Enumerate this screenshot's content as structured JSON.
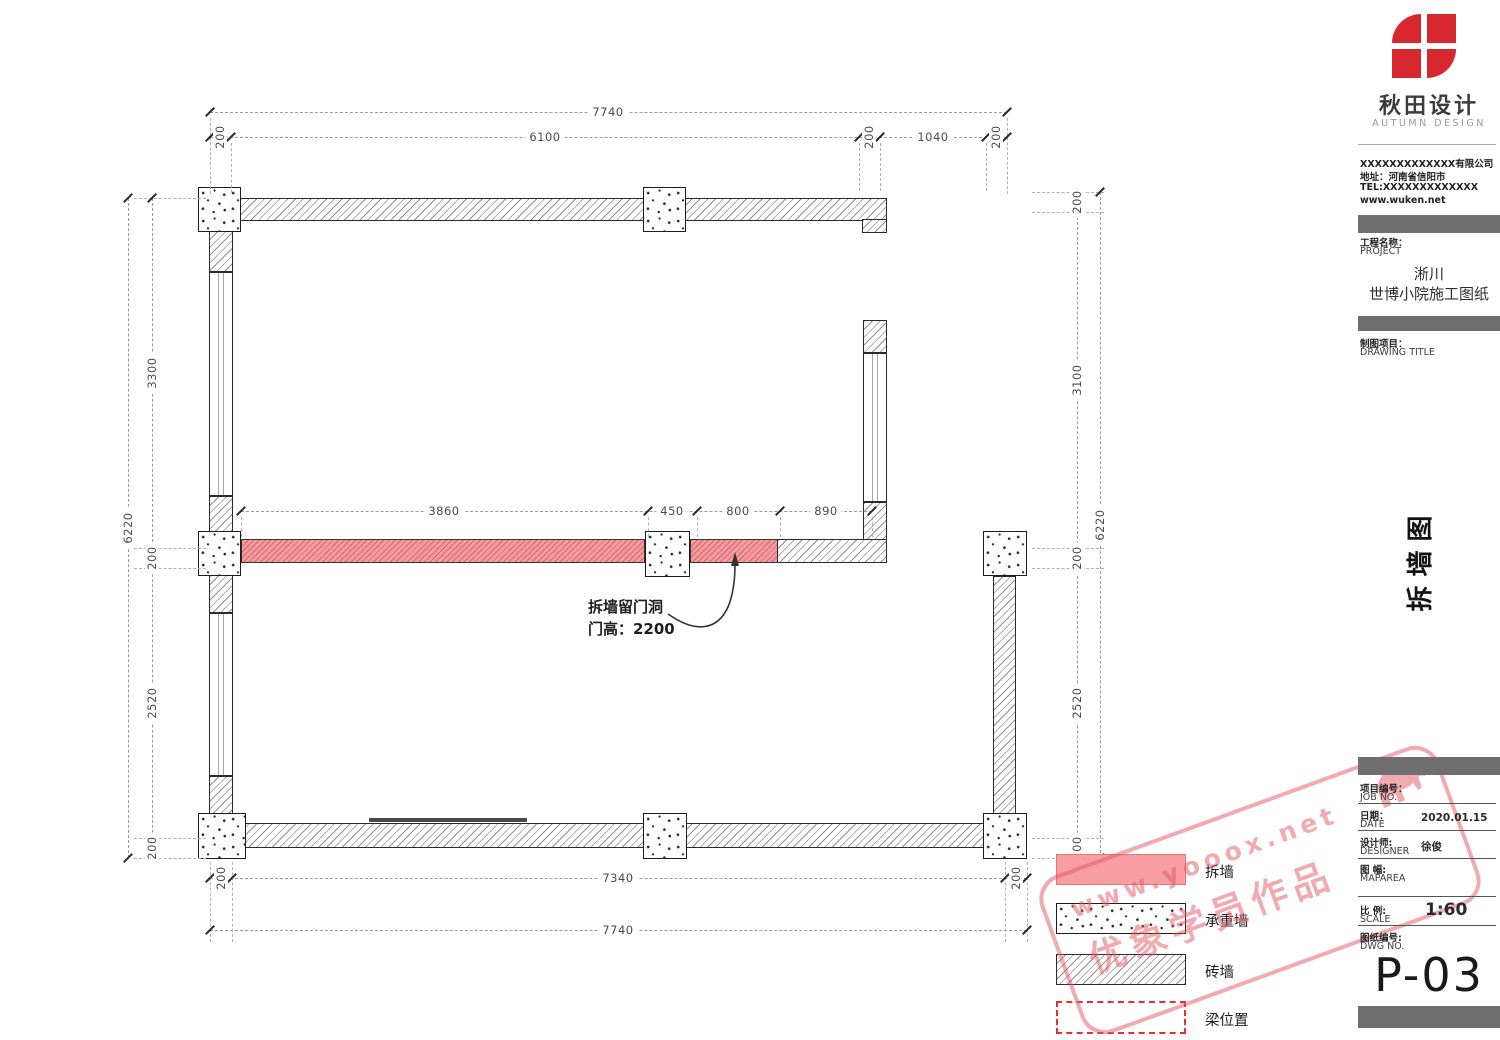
{
  "brand": {
    "logo_cn": "秋田设计",
    "logo_en": "AUTUMN DESIGN",
    "accent_red": "#d7282f"
  },
  "company": {
    "name": "XXXXXXXXXXXXX有限公司",
    "address": "地址：河南省信阳市",
    "tel": "TEL:XXXXXXXXXXXXX",
    "web": "www.wuken.net"
  },
  "project": {
    "label_cn": "工程名称：",
    "label_en": "PROJECT",
    "line1": "淅川",
    "line2": "世博小院施工图纸"
  },
  "drawing_title": {
    "label_cn": "制图项目：",
    "label_en": "DRAWING TITLE",
    "vertical": "拆墙图"
  },
  "fields": {
    "job": {
      "cn": "项目编号：",
      "en": "JOB NO.",
      "value": ""
    },
    "date": {
      "cn": "日期：",
      "en": "DATE",
      "value": "2020.01.15"
    },
    "designer": {
      "cn": "设计师:",
      "en": "DESIGNER",
      "value": "徐俊"
    },
    "maparea": {
      "cn": "图 幅:",
      "en": "MAPAREA",
      "value": ""
    },
    "scale": {
      "cn": "比 例:",
      "en": "SCALE",
      "value": "1:60"
    },
    "dwg": {
      "cn": "图纸编号:",
      "en": "DWG NO.",
      "value": "P-03"
    }
  },
  "plan": {
    "dims": {
      "top_overall": "7740",
      "top_chain": [
        "200",
        "6100",
        "200",
        "1040",
        "200"
      ],
      "left_overall": "6220",
      "left_chain": [
        "3300",
        "200",
        "2520",
        "200"
      ],
      "right_overall": "6220",
      "right_chain": [
        "200",
        "3100",
        "200",
        "2520",
        "200"
      ],
      "mid_chain": [
        "3860",
        "450",
        "800",
        "890"
      ],
      "bottom_chain": [
        "200",
        "7340",
        "200"
      ],
      "bottom_overall": "7740"
    },
    "annotation": {
      "line1": "拆墙留门洞",
      "line2": "门高：2200"
    },
    "colors": {
      "demolition_pink": "#f4999c",
      "wall_line": "#2b2b2b"
    }
  },
  "legend": {
    "items": [
      {
        "id": "demolish",
        "label": "拆墙"
      },
      {
        "id": "loadbearing",
        "label": "承重墙"
      },
      {
        "id": "brick",
        "label": "砖墙"
      },
      {
        "id": "beam",
        "label": "梁位置"
      }
    ]
  },
  "watermark": {
    "line1": "www.yooox.net",
    "line2": "优象学员作品",
    "color": "#e25864"
  }
}
